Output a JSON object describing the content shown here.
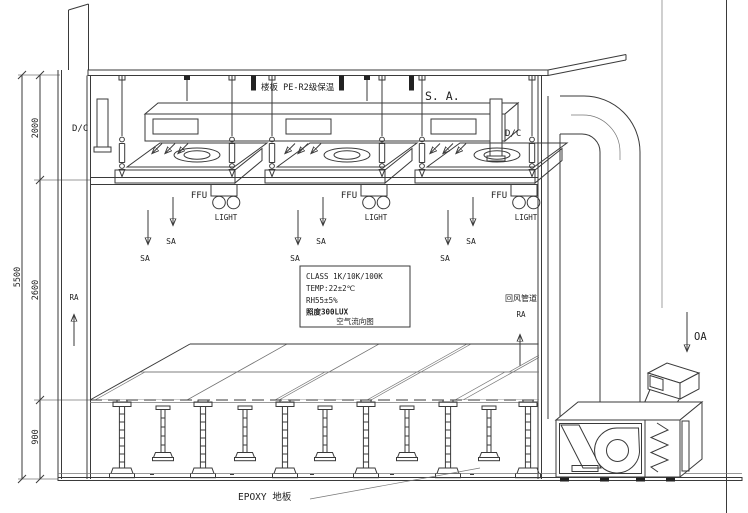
{
  "drawing": {
    "slab_label": "楼板 PE-R2级保温",
    "supply_air_label": "S. A.",
    "dc_label": "D/C",
    "ffu_label": "FFU",
    "light_label": "LIGHT",
    "sa_label": "SA",
    "ra_label": "RA",
    "oa_label": "OA",
    "return_duct_label": "回风管道",
    "epoxy_floor_label": "EPOXY 地板",
    "spec_box": {
      "lines": [
        "CLASS 1K/10K/100K",
        "TEMP:22±2℃",
        "RH55±5%",
        "照度300LUX"
      ],
      "caption": "空气流向图"
    },
    "dimensions": {
      "total_height": "5500",
      "plenum_height": "2000",
      "room_height": "2600",
      "raised_floor_height": "900"
    },
    "colors": {
      "line": "#3a3a3a",
      "background": "#ffffff"
    }
  }
}
